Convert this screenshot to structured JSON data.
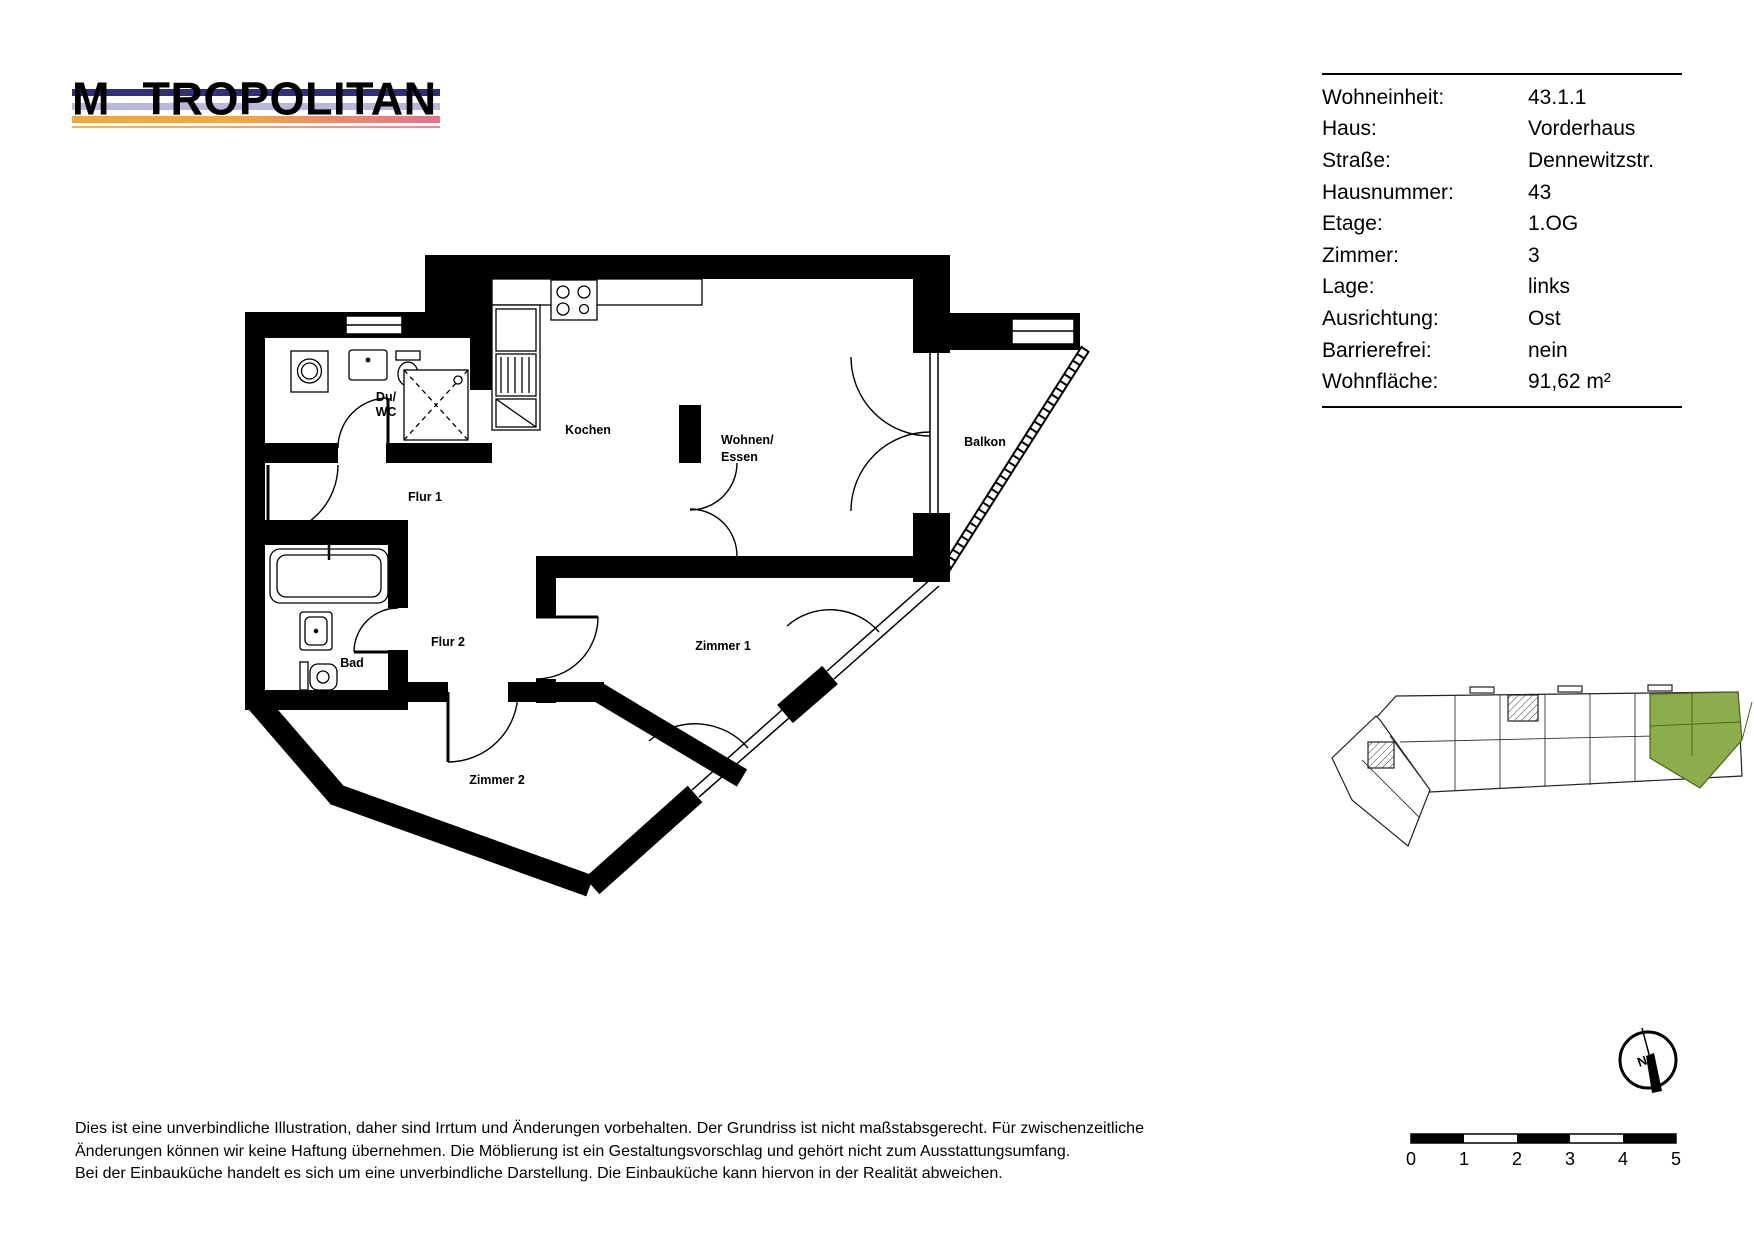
{
  "logo": {
    "prefix": "M",
    "rest": "TROPOLITAN"
  },
  "info": {
    "rows": [
      {
        "label": "Wohneinheit:",
        "value": "43.1.1"
      },
      {
        "label": "Haus:",
        "value": "Vorderhaus"
      },
      {
        "label": "Straße:",
        "value": "Dennewitzstr."
      },
      {
        "label": "Hausnummer:",
        "value": "43"
      },
      {
        "label": "Etage:",
        "value": "1.OG"
      },
      {
        "label": "Zimmer:",
        "value": "3"
      },
      {
        "label": "Lage:",
        "value": "links"
      },
      {
        "label": "Ausrichtung:",
        "value": "Ost"
      },
      {
        "label": "Barrierefrei:",
        "value": "nein"
      },
      {
        "label": "Wohnfläche:",
        "value": "91,62 m²"
      }
    ]
  },
  "plan": {
    "rooms": {
      "du_wc_1": "Du/",
      "du_wc_2": "WC",
      "kochen": "Kochen",
      "wohnen_1": "Wohnen/",
      "wohnen_2": "Essen",
      "balkon": "Balkon",
      "flur1": "Flur 1",
      "flur2": "Flur 2",
      "zimmer1": "Zimmer 1",
      "bad": "Bad",
      "zimmer2": "Zimmer 2"
    }
  },
  "compass": {
    "north_label": "N"
  },
  "scalebar": {
    "ticks": [
      "0",
      "1",
      "2",
      "3",
      "4",
      "5"
    ]
  },
  "disclaimer": {
    "line1": "Dies ist eine unverbindliche Illustration, daher sind Irrtum und Änderungen vorbehalten. Der Grundriss ist nicht maßstabsgerecht. Für zwischenzeitliche",
    "line2": "Änderungen können wir keine Haftung übernehmen. Die Möblierung ist ein Gestaltungsvorschlag und gehört nicht zum Ausstattungsumfang.",
    "line3": "Bei der Einbauküche handelt es sich um eine unverbindliche Darstellung. Die Einbauküche kann hiervon in der Realität abweichen."
  },
  "colors": {
    "wall_black": "#000000",
    "stripe_navy": "#312f7a",
    "stripe_lavender": "#b9b7dd",
    "stripe_orange": "#f2a93b",
    "stripe_pink": "#e9708e",
    "highlight_green": "#8cad4b"
  }
}
